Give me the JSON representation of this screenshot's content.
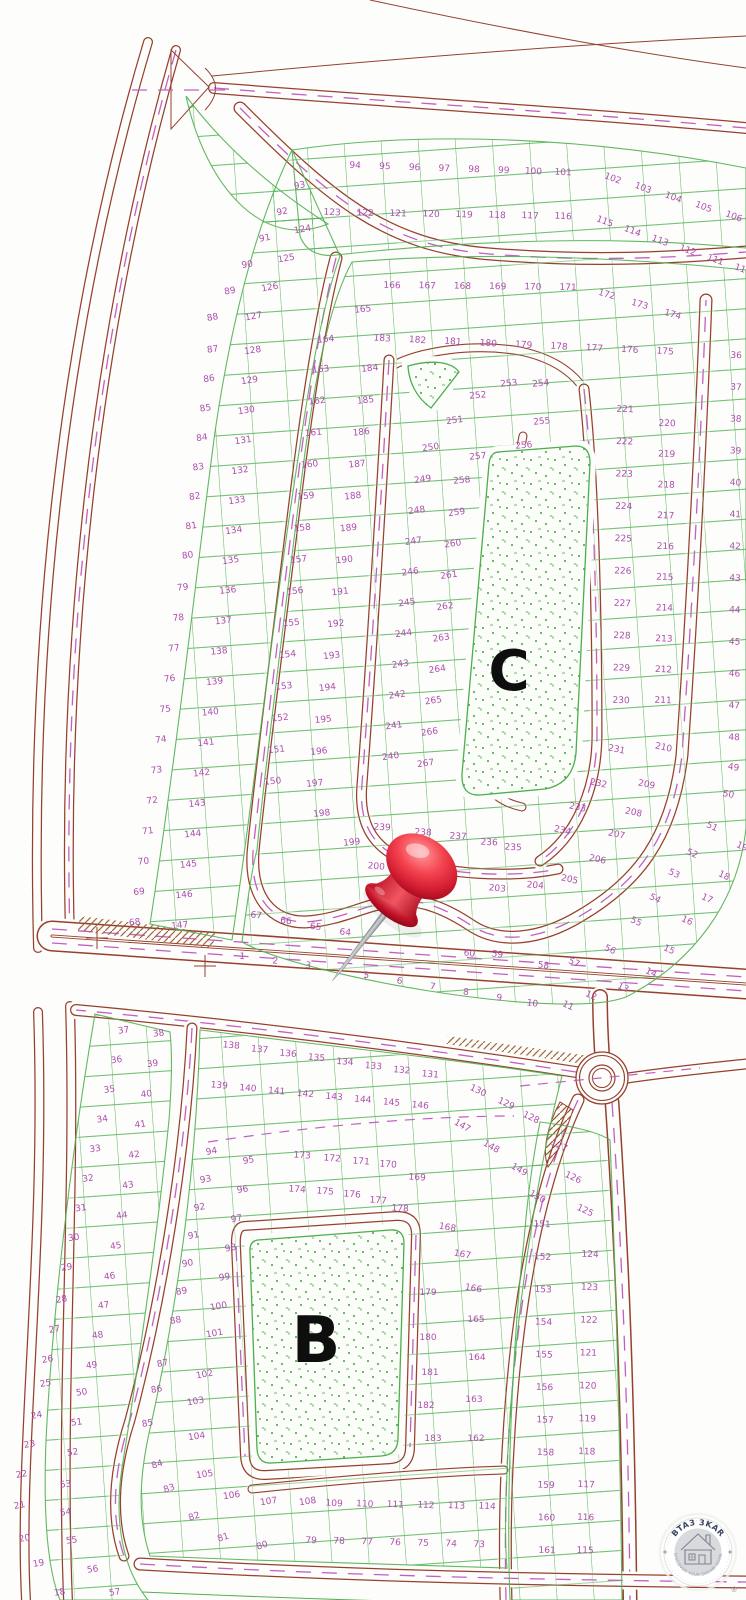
{
  "areas": {
    "c": "C",
    "b": "B"
  },
  "logo": {
    "brand": "BTA3 3KAR",
    "tagline": "DISCOVER YOUR DREAM HOME",
    "registered": "®"
  },
  "colors": {
    "road": "#96402f",
    "centerline_dash": "#c35fc3",
    "parcel_line": "#52b153",
    "plot_number": "#ae4fae",
    "pin_red": "#d01b30",
    "background": "#fdfdfb"
  },
  "plot_label_groups": [
    {
      "labels": [
        "94",
        "95",
        "96",
        "97",
        "98",
        "99",
        "100",
        "101"
      ],
      "from": [
        355,
        168
      ],
      "to": [
        563,
        175
      ],
      "rot": 3
    },
    {
      "labels": [
        "102",
        "103",
        "104",
        "105",
        "106"
      ],
      "from": [
        612,
        181
      ],
      "to": [
        733,
        219
      ],
      "rot": 20
    },
    {
      "labels": [
        "123",
        "122",
        "121",
        "120",
        "119",
        "118",
        "117",
        "116"
      ],
      "from": [
        332,
        215
      ],
      "to": [
        563,
        219
      ],
      "rot": 3
    },
    {
      "labels": [
        "115",
        "114",
        "113",
        "112",
        "111",
        "110"
      ],
      "from": [
        604,
        224
      ],
      "to": [
        742,
        272
      ],
      "rot": 20
    },
    {
      "labels": [
        "93",
        "92",
        "91",
        "90",
        "89",
        "88"
      ],
      "from": [
        300,
        188
      ],
      "to": [
        213,
        320
      ],
      "rot": -10
    },
    {
      "labels": [
        "87",
        "86",
        "85",
        "84",
        "83",
        "82",
        "81",
        "80"
      ],
      "from": [
        213,
        352
      ],
      "to": [
        188,
        558
      ],
      "rot": -8
    },
    {
      "labels": [
        "79",
        "78",
        "77",
        "76",
        "75",
        "74",
        "73",
        "72",
        "71",
        "70",
        "69",
        "68"
      ],
      "from": [
        183,
        590
      ],
      "to": [
        135,
        925
      ],
      "rot": -6
    },
    {
      "labels": [
        "124",
        "125",
        "126",
        "127"
      ],
      "from": [
        303,
        232
      ],
      "to": [
        254,
        319
      ],
      "rot": -10
    },
    {
      "labels": [
        "128",
        "129",
        "130",
        "131",
        "132",
        "133",
        "134",
        "135"
      ],
      "from": [
        253,
        353
      ],
      "to": [
        231,
        563
      ],
      "rot": -8
    },
    {
      "labels": [
        "136",
        "137",
        "138",
        "139",
        "140",
        "141",
        "142",
        "143",
        "144",
        "145",
        "146",
        "147"
      ],
      "from": [
        228,
        593
      ],
      "to": [
        180,
        928
      ],
      "rot": -6
    },
    {
      "labels": [
        "166",
        "167",
        "168",
        "169",
        "170",
        "171"
      ],
      "from": [
        392,
        288
      ],
      "to": [
        568,
        290
      ],
      "rot": 2
    },
    {
      "labels": [
        "172",
        "173",
        "174"
      ],
      "from": [
        606,
        297
      ],
      "to": [
        672,
        317
      ],
      "rot": 16
    },
    {
      "labels": [
        "183",
        "182",
        "181",
        "180",
        "179",
        "178",
        "177",
        "176",
        "175"
      ],
      "from": [
        382,
        341
      ],
      "to": [
        665,
        354
      ],
      "rot": 4
    },
    {
      "labels": [
        "165",
        "164"
      ],
      "pts": [
        [
          363,
          312
        ],
        [
          326,
          342
        ]
      ],
      "rot": -6
    },
    {
      "labels": [
        "163",
        "162",
        "161",
        "160",
        "159",
        "158",
        "157",
        "156",
        "155",
        "154",
        "153",
        "152",
        "151",
        "150"
      ],
      "from": [
        321,
        372
      ],
      "to": [
        273,
        784
      ],
      "rot": -6
    },
    {
      "labels": [
        "184",
        "185",
        "186",
        "187",
        "188",
        "189",
        "190",
        "191",
        "192",
        "193",
        "194",
        "195",
        "196",
        "197"
      ],
      "from": [
        370,
        371
      ],
      "to": [
        315,
        786
      ],
      "rot": -6
    },
    {
      "labels": [
        "198",
        "199"
      ],
      "pts": [
        [
          322,
          816
        ],
        [
          352,
          845
        ]
      ],
      "rot": -6
    },
    {
      "labels": [
        "251",
        "250",
        "249"
      ],
      "pts": [
        [
          455,
          423
        ],
        [
          431,
          450
        ],
        [
          423,
          482
        ]
      ],
      "rot": -8
    },
    {
      "labels": [
        "248",
        "247",
        "246",
        "245",
        "244",
        "243",
        "242",
        "241",
        "240"
      ],
      "from": [
        417,
        513
      ],
      "to": [
        391,
        759
      ],
      "rot": -8
    },
    {
      "labels": [
        "259",
        "260",
        "261",
        "262",
        "263",
        "264",
        "265",
        "266",
        "267"
      ],
      "from": [
        457,
        515
      ],
      "to": [
        426,
        766
      ],
      "rot": -8
    },
    {
      "labels": [
        "252",
        "253",
        "254",
        "255",
        "256",
        "257",
        "258"
      ],
      "pts": [
        [
          478,
          398
        ],
        [
          509,
          386
        ],
        [
          541,
          386
        ],
        [
          542,
          424
        ],
        [
          524,
          448
        ],
        [
          478,
          459
        ],
        [
          462,
          483
        ]
      ],
      "rot": -5
    },
    {
      "labels": [
        "221",
        "222",
        "223",
        "224",
        "225",
        "226",
        "227",
        "228",
        "229",
        "230"
      ],
      "from": [
        625,
        412
      ],
      "to": [
        621,
        703
      ],
      "rot": 2
    },
    {
      "labels": [
        "220",
        "219",
        "218",
        "217",
        "216",
        "215",
        "214",
        "213",
        "212",
        "211"
      ],
      "from": [
        667,
        426
      ],
      "to": [
        663,
        703
      ],
      "rot": 2
    },
    {
      "labels": [
        "36",
        "37",
        "38",
        "39",
        "40",
        "41",
        "42",
        "43",
        "44",
        "45",
        "46",
        "47",
        "48"
      ],
      "from": [
        736,
        358
      ],
      "to": [
        734,
        740
      ],
      "rot": 3
    },
    {
      "labels": [
        "49",
        "50"
      ],
      "pts": [
        [
          733,
          770
        ],
        [
          728,
          797
        ]
      ],
      "rot": 10
    },
    {
      "labels": [
        "51",
        "52",
        "53",
        "54",
        "55",
        "56",
        "57"
      ],
      "pts": [
        [
          711,
          829
        ],
        [
          691,
          856
        ],
        [
          673,
          876
        ],
        [
          654,
          901
        ],
        [
          635,
          924
        ],
        [
          609,
          952
        ],
        [
          573,
          965
        ]
      ],
      "rot": 25
    },
    {
      "labels": [
        "19",
        "18",
        "17",
        "16",
        "15",
        "14",
        "13",
        "12",
        "11"
      ],
      "pts": [
        [
          741,
          849
        ],
        [
          723,
          878
        ],
        [
          706,
          901
        ],
        [
          686,
          923
        ],
        [
          668,
          952
        ],
        [
          650,
          975
        ],
        [
          622,
          990
        ],
        [
          590,
          998
        ],
        [
          567,
          1008
        ]
      ],
      "rot": 25
    },
    {
      "labels": [
        "231",
        "210",
        "232",
        "209",
        "233",
        "208",
        "234",
        "207",
        "206",
        "205"
      ],
      "pts": [
        [
          616,
          752
        ],
        [
          663,
          750
        ],
        [
          598,
          786
        ],
        [
          646,
          787
        ],
        [
          577,
          810
        ],
        [
          633,
          815
        ],
        [
          562,
          833
        ],
        [
          616,
          837
        ],
        [
          597,
          862
        ],
        [
          569,
          882
        ]
      ],
      "rot": 12
    },
    {
      "labels": [
        "67",
        "66",
        "65",
        "64"
      ],
      "from": [
        256,
        918
      ],
      "to": [
        345,
        935
      ],
      "rot": 6
    },
    {
      "labels": [
        "1",
        "2",
        "3"
      ],
      "from": [
        242,
        959
      ],
      "to": [
        308,
        968
      ],
      "rot": 6
    },
    {
      "labels": [
        "5",
        "6",
        "7",
        "8",
        "9",
        "10"
      ],
      "from": [
        366,
        978
      ],
      "to": [
        532,
        1006
      ],
      "rot": 8
    },
    {
      "labels": [
        "60",
        "59",
        "58"
      ],
      "pts": [
        [
          469,
          956
        ],
        [
          497,
          957
        ],
        [
          543,
          968
        ]
      ],
      "rot": 8
    },
    {
      "labels": [
        "200",
        "201",
        "203",
        "204"
      ],
      "pts": [
        [
          376,
          869
        ],
        [
          417,
          872
        ],
        [
          497,
          891
        ],
        [
          535,
          888
        ]
      ],
      "rot": 5
    },
    {
      "labels": [
        "235",
        "236",
        "237",
        "238",
        "239"
      ],
      "pts": [
        [
          513,
          850
        ],
        [
          489,
          845
        ],
        [
          458,
          839
        ],
        [
          423,
          835
        ],
        [
          382,
          830
        ]
      ],
      "rot": 3
    },
    {
      "labels": [
        "37",
        "36",
        "35",
        "34",
        "33",
        "32",
        "31",
        "30",
        "29"
      ],
      "from": [
        124,
        1033
      ],
      "to": [
        67,
        1270
      ],
      "rot": -8
    },
    {
      "labels": [
        "28",
        "27",
        "26",
        "25",
        "24",
        "23",
        "22",
        "21",
        "20",
        "19",
        "18"
      ],
      "pts": [
        [
          62,
          1302
        ],
        [
          55,
          1332
        ],
        [
          48,
          1362
        ],
        [
          46,
          1386
        ],
        [
          37,
          1418
        ],
        [
          30,
          1447
        ],
        [
          22,
          1477
        ],
        [
          20,
          1508
        ],
        [
          25,
          1541
        ],
        [
          39,
          1566
        ],
        [
          60,
          1595
        ]
      ],
      "rot": -10
    },
    {
      "labels": [
        "38",
        "39",
        "40",
        "41",
        "42",
        "43",
        "44",
        "45",
        "46"
      ],
      "from": [
        159,
        1036
      ],
      "to": [
        110,
        1279
      ],
      "rot": -8
    },
    {
      "labels": [
        "47",
        "48",
        "49",
        "50",
        "51",
        "52",
        "53",
        "54",
        "55",
        "56",
        "57"
      ],
      "pts": [
        [
          104,
          1308
        ],
        [
          98,
          1338
        ],
        [
          92,
          1368
        ],
        [
          82,
          1395
        ],
        [
          77,
          1425
        ],
        [
          73,
          1455
        ],
        [
          66,
          1487
        ],
        [
          66,
          1515
        ],
        [
          72,
          1543
        ],
        [
          93,
          1572
        ],
        [
          115,
          1595
        ]
      ],
      "rot": -8
    },
    {
      "labels": [
        "138",
        "137",
        "136",
        "135",
        "134",
        "133",
        "132",
        "131"
      ],
      "from": [
        231,
        1048
      ],
      "to": [
        430,
        1077
      ],
      "rot": 5
    },
    {
      "labels": [
        "130",
        "129",
        "128",
        "127",
        "126",
        "125"
      ],
      "pts": [
        [
          477,
          1093
        ],
        [
          505,
          1106
        ],
        [
          530,
          1120
        ],
        [
          558,
          1148
        ],
        [
          572,
          1180
        ],
        [
          584,
          1213
        ]
      ],
      "rot": 25
    },
    {
      "labels": [
        "139",
        "140",
        "141",
        "142",
        "143",
        "144",
        "145",
        "146"
      ],
      "from": [
        219,
        1088
      ],
      "to": [
        420,
        1108
      ],
      "rot": 5
    },
    {
      "labels": [
        "147",
        "148",
        "149",
        "150"
      ],
      "pts": [
        [
          461,
          1128
        ],
        [
          490,
          1149
        ],
        [
          518,
          1172
        ],
        [
          536,
          1199
        ]
      ],
      "rot": 30
    },
    {
      "labels": [
        "94",
        "93",
        "92",
        "91",
        "90",
        "89"
      ],
      "from": [
        212,
        1154
      ],
      "to": [
        182,
        1294
      ],
      "rot": -10
    },
    {
      "labels": [
        "88",
        "87",
        "86",
        "85"
      ],
      "pts": [
        [
          176,
          1323
        ],
        [
          163,
          1366
        ],
        [
          157,
          1392
        ],
        [
          148,
          1426
        ]
      ],
      "rot": -10
    },
    {
      "labels": [
        "84",
        "83",
        "82",
        "81",
        "80"
      ],
      "pts": [
        [
          158,
          1467
        ],
        [
          170,
          1491
        ],
        [
          195,
          1519
        ],
        [
          224,
          1540
        ],
        [
          263,
          1548
        ]
      ],
      "rot": -18
    },
    {
      "labels": [
        "95",
        "96",
        "97",
        "98",
        "99",
        "100"
      ],
      "from": [
        249,
        1163
      ],
      "to": [
        219,
        1309
      ],
      "rot": -10
    },
    {
      "labels": [
        "101",
        "102",
        "103"
      ],
      "pts": [
        [
          215,
          1336
        ],
        [
          205,
          1377
        ],
        [
          196,
          1404
        ]
      ],
      "rot": -10
    },
    {
      "labels": [
        "104",
        "105",
        "106",
        "107",
        "108"
      ],
      "pts": [
        [
          197,
          1439
        ],
        [
          205,
          1477
        ],
        [
          232,
          1498
        ],
        [
          269,
          1504
        ],
        [
          308,
          1504
        ]
      ],
      "rot": -8
    },
    {
      "labels": [
        "109",
        "110",
        "111",
        "112",
        "113",
        "114"
      ],
      "from": [
        334,
        1506
      ],
      "to": [
        487,
        1509
      ],
      "rot": 3
    },
    {
      "labels": [
        "79",
        "78",
        "77",
        "76",
        "75",
        "74",
        "73"
      ],
      "from": [
        311,
        1543
      ],
      "to": [
        479,
        1547
      ],
      "rot": 3
    },
    {
      "labels": [
        "173",
        "172",
        "171",
        "170",
        "169"
      ],
      "pts": [
        [
          302,
          1158
        ],
        [
          332,
          1161
        ],
        [
          361,
          1164
        ],
        [
          388,
          1167
        ],
        [
          417,
          1180
        ]
      ],
      "rot": 4
    },
    {
      "labels": [
        "174",
        "175",
        "176",
        "177",
        "178"
      ],
      "pts": [
        [
          297,
          1192
        ],
        [
          325,
          1194
        ],
        [
          352,
          1197
        ],
        [
          378,
          1203
        ],
        [
          400,
          1211
        ]
      ],
      "rot": 4
    },
    {
      "labels": [
        "168",
        "167",
        "166"
      ],
      "pts": [
        [
          447,
          1230
        ],
        [
          462,
          1257
        ],
        [
          473,
          1291
        ]
      ],
      "rot": 10
    },
    {
      "labels": [
        "179",
        "180",
        "181",
        "182",
        "183"
      ],
      "pts": [
        [
          428,
          1295
        ],
        [
          428,
          1340
        ],
        [
          430,
          1375
        ],
        [
          426,
          1408
        ],
        [
          433,
          1441
        ]
      ],
      "rot": 0
    },
    {
      "labels": [
        "165",
        "164",
        "163",
        "162"
      ],
      "pts": [
        [
          476,
          1322
        ],
        [
          477,
          1360
        ],
        [
          474,
          1402
        ],
        [
          476,
          1441
        ]
      ],
      "rot": 0
    },
    {
      "labels": [
        "151",
        "152",
        "153",
        "154",
        "155",
        "156",
        "157",
        "158",
        "159",
        "160",
        "161"
      ],
      "from": [
        542,
        1227
      ],
      "to": [
        547,
        1553
      ],
      "rot": 2
    },
    {
      "labels": [
        "124",
        "123",
        "122",
        "121",
        "120",
        "119",
        "118",
        "117",
        "116",
        "115"
      ],
      "from": [
        590,
        1257
      ],
      "to": [
        585,
        1553
      ],
      "rot": 2
    }
  ]
}
